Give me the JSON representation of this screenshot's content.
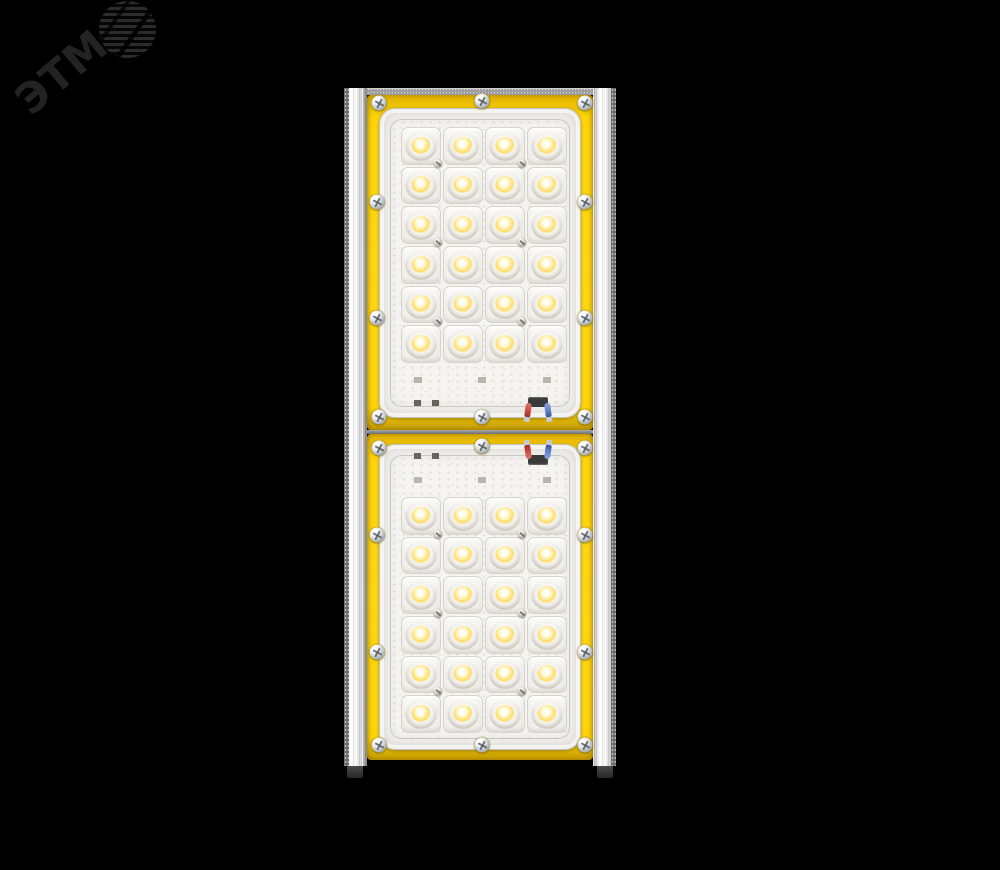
{
  "background_color": "#000000",
  "watermark": {
    "text": "ЭТМ",
    "icon": "striped-globe",
    "color": "#232323"
  },
  "product": {
    "type": "led-floodlight",
    "appearance": "two stacked LED modules with yellow gasket frames and silver heatsink side rails",
    "module_count": 2,
    "total_led_count": 48,
    "led_modules": [
      {
        "position": "top",
        "led_rows": 6,
        "led_columns": 4,
        "led_count": 24,
        "frame_screw_count": 10,
        "wire_colors": [
          "red",
          "blue"
        ]
      },
      {
        "position": "bottom",
        "led_rows": 6,
        "led_columns": 4,
        "led_count": 24,
        "frame_screw_count": 10,
        "wire_colors": [
          "red",
          "blue"
        ]
      }
    ],
    "colors": {
      "gasket_frame": "#FFD60A",
      "housing_silver": "#E9E9E9",
      "lens_plate": "#F2F1EE",
      "led_phosphor": "#FFDC64",
      "wire_red": "#C2453A",
      "wire_blue": "#5878C4"
    }
  }
}
